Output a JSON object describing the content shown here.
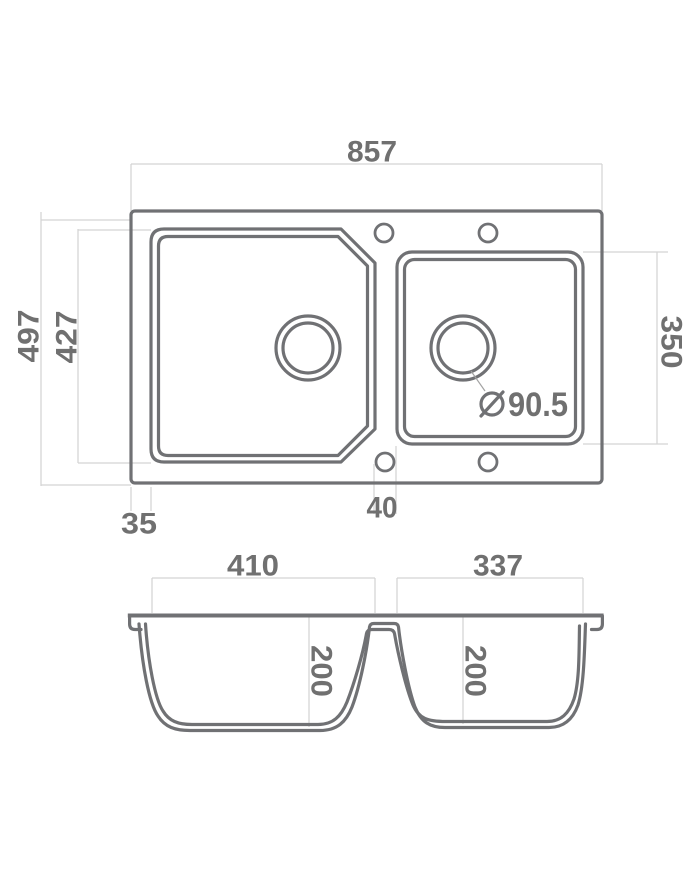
{
  "colors": {
    "line": "#707174",
    "dim_line": "#d3d3d3",
    "text": "#707070",
    "leader": "#a3a3a3",
    "background": "#ffffff"
  },
  "icons": {
    "diameter_symbol": "⌀"
  },
  "top_view": {
    "overall_width": "857",
    "overall_depth": "497",
    "main_bowl_depth": "427",
    "right_bowl_depth": "350",
    "left_edge_offset": "35",
    "divider_width": "40",
    "drain_diameter": "90.5"
  },
  "section_view": {
    "left_bowl_width": "410",
    "right_bowl_width": "337",
    "left_bowl_depth": "200",
    "right_bowl_depth": "200"
  }
}
